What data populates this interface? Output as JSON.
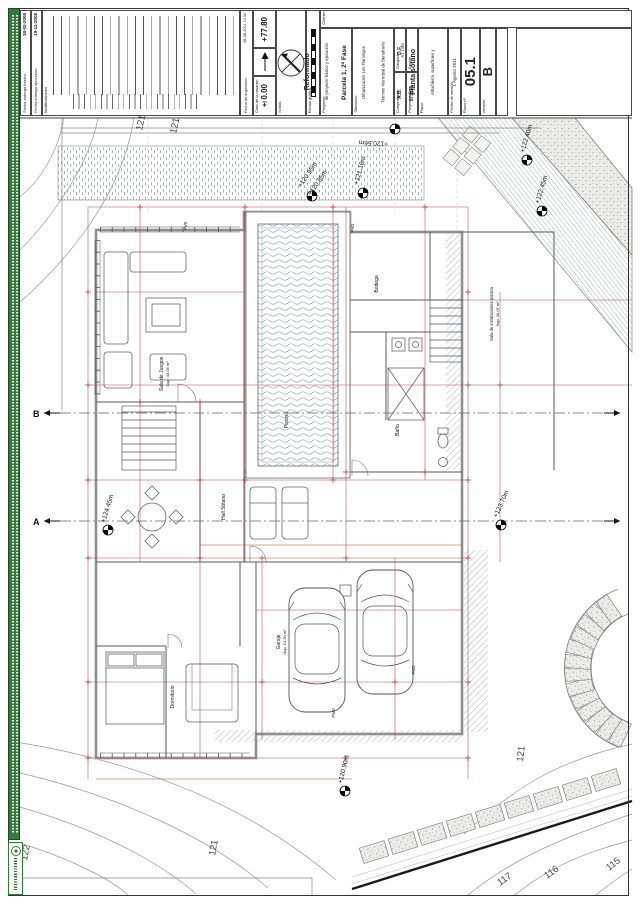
{
  "sheet": {
    "revisions": {
      "basico_label": "Fecha entrega básico:",
      "basico_date": "18-02-2008",
      "ejecucion_label": "Fecha entrega ejecución:",
      "ejecucion_date": "19-11-2008",
      "mods_label": "Modificaciones"
    },
    "print_info": {
      "label": "Fecha de impresión:",
      "value": "08-08-2011 10:34"
    },
    "datum": {
      "altitude_value": "+77.80",
      "rasante_label": "Cota de la rasante:",
      "rasante_value": "±0.00",
      "notas_label": "Notas:",
      "escala_grafica_label": "Escala gráfica:"
    },
    "title_block": {
      "cliente_label": "Cliente:",
      "proyecto_label": "Proyecto:",
      "proyecto_line1": "Reformado",
      "proyecto_line2": "de proyecto básico y ejecución",
      "proyecto_line3": "vivienda unifamiliar y piscina",
      "situacion_label": "Situación:",
      "situacion_line1": "Parcela 1, 2ª Fase",
      "situacion_line2": "Urbanización Los Flamingos",
      "situacion_line3": "Término Municipal de Benahavís",
      "situacion_line4": "Málaga",
      "dibujado_label": "Dibujado:",
      "dibujado_value": "D.F.",
      "comprobado_label": "Comprobado:",
      "comprobado_value": "A.B.",
      "escala_label": "Escala:",
      "escala_line1": "A1 1/50",
      "escala_line2": "A3 1/100",
      "proyecto_num_label": "Proyecto nº:",
      "proyecto_num_value": "575/08",
      "plano_label": "Plano:",
      "plano_line1": "Planta sótano",
      "plano_line2": "Albañilería, superficies y",
      "plano_line3": "cotas de carpintería.",
      "fecha_version_label": "Fecha de versión:",
      "fecha_version_value": "1 Agosto 2011",
      "plano_num_label": "Plano nº:",
      "plano_num_value": "05.1",
      "version_label": "Versión:",
      "version_value": "B"
    }
  },
  "plan": {
    "levels": [
      {
        "label": "+120.56m"
      },
      {
        "label": "+120.95m"
      },
      {
        "label": "+120.85m"
      },
      {
        "label": "+121.10m"
      },
      {
        "label": "+122.40m"
      },
      {
        "label": "+122.45m"
      },
      {
        "label": "+123.70m"
      },
      {
        "label": "+124.45m"
      },
      {
        "label": "+120.90m"
      }
    ],
    "contours": [
      "121",
      "121",
      "122",
      "121",
      "121",
      "117",
      "116",
      "115"
    ],
    "codes": [
      "PV0",
      "PM1",
      "PM2",
      "PM0"
    ],
    "sections": {
      "a": "A",
      "b": "B"
    },
    "rooms": [
      {
        "name": "Sala de Juegos",
        "area": "Sup: 43.05 m²"
      },
      {
        "name": "Piscina",
        "area": ""
      },
      {
        "name": "Hall Sótano",
        "area": ""
      },
      {
        "name": "Baño",
        "area": ""
      },
      {
        "name": "Bodega",
        "area": ""
      },
      {
        "name": "Sala de instalaciones piscina",
        "area": "Sup: 40.07 m²"
      },
      {
        "name": "Garaje",
        "area": "Sup: 51.30 m²"
      },
      {
        "name": "Dormitorio",
        "area": ""
      }
    ]
  },
  "colors": {
    "dimension_red": "#b23636",
    "wall_gray": "#c9c9c9",
    "green": "#35793b"
  }
}
